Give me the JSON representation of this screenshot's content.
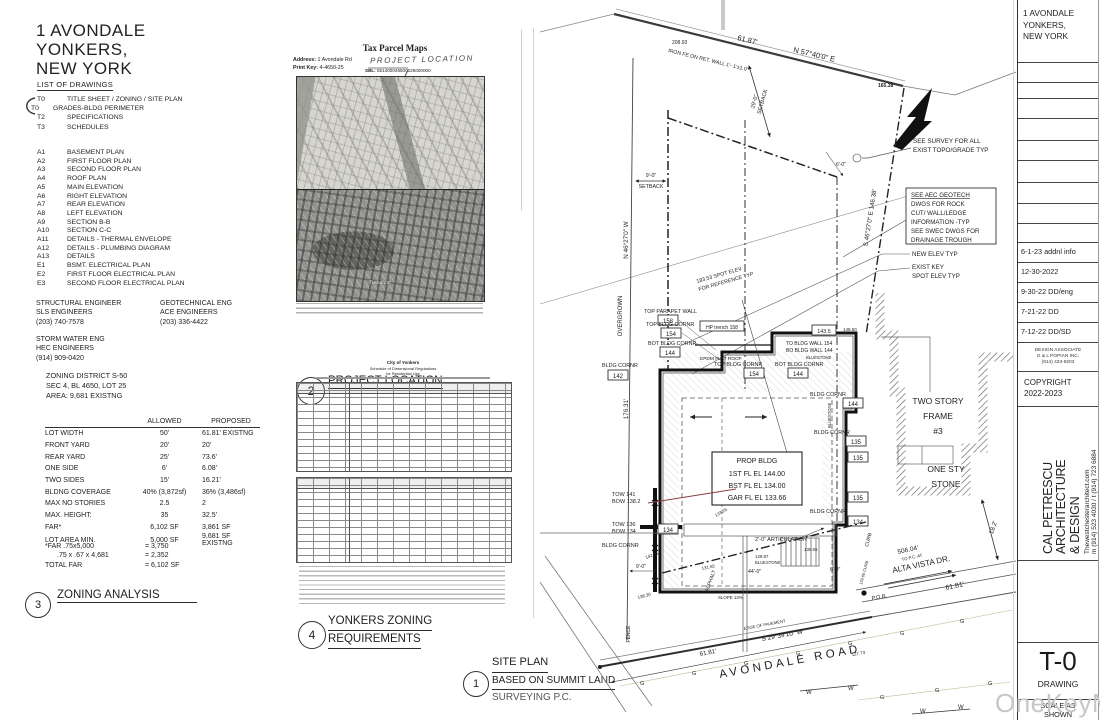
{
  "project": {
    "title_lines": [
      "1 AVONDALE",
      "YONKERS,",
      "NEW YORK"
    ]
  },
  "drawing_list": {
    "heading": "LIST OF DRAWINGS",
    "t_items": [
      {
        "code": "T0",
        "name": "TITLE SHEET / ZONING / SITE PLAN"
      },
      {
        "code": "T0",
        "name": "GRADES-BLDG PERIMETER"
      },
      {
        "code": "T2",
        "name": "SPECIFICATIONS"
      },
      {
        "code": "T3",
        "name": "SCHEDULES"
      }
    ],
    "a_items": [
      {
        "code": "A1",
        "name": "BASEMENT PLAN"
      },
      {
        "code": "A2",
        "name": "FIRST FLOOR PLAN"
      },
      {
        "code": "A3",
        "name": "SECOND FLOOR PLAN"
      },
      {
        "code": "A4",
        "name": "ROOF PLAN"
      },
      {
        "code": "A5",
        "name": "MAIN ELEVATION"
      },
      {
        "code": "A6",
        "name": "RIGHT ELEVATION"
      },
      {
        "code": "A7",
        "name": "REAR ELEVATION"
      },
      {
        "code": "A8",
        "name": "LEFT ELEVATION"
      },
      {
        "code": "A9",
        "name": "SECTION B-B"
      },
      {
        "code": "A10",
        "name": "SECTION C-C"
      },
      {
        "code": "A11",
        "name": "DETAILS - THERMAL ENVELOPE"
      },
      {
        "code": "A12",
        "name": "DETAILS - PLUMBING DIAGRAM"
      },
      {
        "code": "A13",
        "name": "DETAILS"
      },
      {
        "code": "E1",
        "name": "BSMT. ELECTRICAL PLAN"
      },
      {
        "code": "E2",
        "name": "FIRST FLOOR ELECTRICAL PLAN"
      },
      {
        "code": "E3",
        "name": "SECOND FLOOR ELECTRICAL PLAN"
      }
    ]
  },
  "engineers": [
    {
      "title": "STRUCTURAL ENGINEER",
      "firm": "SLS ENGINEERS",
      "phone": "(203) 740-7578"
    },
    {
      "title": "GEOTECHNICAL ENG",
      "firm": "ACE ENGINEERS",
      "phone": "(203) 336-4422"
    },
    {
      "title": "STORM WATER ENG",
      "firm": "HEC ENGINEERS",
      "phone": "(914) 909-0420"
    }
  ],
  "zoning": {
    "district_lines": [
      "ZONING DISTRICT S-50",
      "SEC 4, BL 4650, LOT 25",
      "AREA: 9,681 EXISTNG"
    ],
    "table": {
      "headers": [
        "ALLOWED",
        "PROPOSED"
      ],
      "rows": [
        [
          "LOT WIDTH",
          "50'",
          "61.81'  EXISTNG"
        ],
        [
          "FRONT YARD",
          "20'",
          "20'"
        ],
        [
          "REAR YARD",
          "25'",
          "73.6'"
        ],
        [
          "ONE SIDE",
          "6'",
          "6.08'"
        ],
        [
          "TWO SIDES",
          "15'",
          "16.21'"
        ],
        [
          "BLDNG COVERAGE",
          "40% (3,872sf)",
          "36% (3,486sf)"
        ],
        [
          "MAX NO STORIES",
          "2.5",
          "2"
        ],
        [
          "MAX. HEIGHT:",
          "35",
          "32.5'"
        ],
        [
          "FAR*",
          "6,102  SF",
          "3,861 SF"
        ],
        [
          "LOT AREA MIN.",
          "5,000 SF",
          "9,681 SF  EXISTNG"
        ]
      ]
    },
    "far": [
      [
        "*FAR .75x5,000",
        "= 3,750"
      ],
      [
        ".75 x .67 x 4,681",
        "= 2,352"
      ],
      [
        "TOTAL FAR",
        "= 6,102 SF"
      ]
    ]
  },
  "callouts": {
    "c1": {
      "num": "1",
      "l1": "SITE PLAN",
      "l2": "BASED ON SUMMIT LAND",
      "l3": "SURVEYING P.C."
    },
    "c2": {
      "num": "2",
      "label": "PROJECT LOCATION"
    },
    "c3": {
      "num": "3",
      "label": "ZONING ANALYSIS"
    },
    "c4": {
      "num": "4",
      "l1": "YONKERS ZONING",
      "l2": "REQUIREMENTS"
    }
  },
  "parcel": {
    "title": "Tax Parcel Maps",
    "address_label": "Address:",
    "address": "1 Avondale Rd",
    "printkey_label": "Print Key:",
    "printkey": "4-4650-25",
    "sbl_label": "SBL:",
    "sbl": "551400046500025000000",
    "handwriting": "PROJECT LOCATION",
    "map_town": "Tuckahoe"
  },
  "yonkers": {
    "h1": "City of Yonkers",
    "h2": "Schedule of Dimensional Regulations",
    "h3": "for Residential Use"
  },
  "site": {
    "labels": {
      "dist_top": "61.87'",
      "brg_top": "N 57°40'0\" E",
      "iron": "IRON FE ON RET. WALL  1'- 1'±1.0'",
      "s20893": "208.93",
      "s16538": "165.38",
      "sb29_1": "29'-0\"",
      "sb29_2": "SETBACK",
      "survey1": "SEE SURVEY FOR ALL",
      "survey2": "EXIST TOPO/GRADE TYP",
      "aec1": "SEE AEC GEOTECH",
      "aec2": "DWGS FOR ROCK",
      "aec3": "CUT/ WALL/LEDGE",
      "aec4": "INFORMATION -TYP",
      "aec5": "SEE SWEC DWGS FOR",
      "aec6": "DRAINAGE TROUGH",
      "newelev": "NEW ELEV TYP",
      "ek1": "EXIST KEY",
      "ek2": "SPOT ELEV TYP",
      "brg_right": "S 46°27'0\" E   146.38'",
      "brg_left": "N 46°27'0\" W",
      "overgrown": "OVERGROWN",
      "len_left": "176.31'",
      "sb9_1": "9'-0\"",
      "sb9_2": "SETBACK",
      "ref1": "183.53 SPOT ELEV",
      "ref2": "FOR REFERENCE TYP",
      "tpw": "TOP PARAPET WALL",
      "v158": "158",
      "tbc": "TOP BLDG CORNR",
      "v154": "154",
      "bbc": "BOT BLDG CORNR",
      "v144": "144",
      "hp": "HP trench 158",
      "epdm": "EPDM FLAT ROOF",
      "towall": "TO BLDG WALL 154",
      "bowall": "BO BLDG WALL 144",
      "bluestone": "BLUESTONE",
      "s1435": "143.5",
      "s14850": "148.50",
      "bc": "BLDG CORNR",
      "v142": "142",
      "v135": "135",
      "v134": "134",
      "prop1": "PROP BLDG",
      "prop2": "1ST FL EL 144.00",
      "prop3": "BST FL EL 134.00",
      "prop4": "GAR FL EL 133.66",
      "artic": "2'-0\" ARTICULATION",
      "tow141": "TOW 141",
      "bow1382": "BOW 138.2",
      "tow136": "TOW 136",
      "bow134": "BOW 134",
      "d9": "9'-0\"",
      "s13830": "138.30",
      "fence": "FENCE",
      "asphalt": "ASPHALT",
      "slope": "SLOPE 13%",
      "d44": "44'-0\"",
      "d6": "6'-0\"",
      "s13055": "130.55",
      "s12987": "129.87",
      "s13325": "133.25",
      "s14295": "142.95",
      "s13165": "131.65",
      "two1": "TWO STORY",
      "two2": "FRAME",
      "two3": "#3",
      "one1": "ONE STY",
      "one2": "STONE",
      "d182": "18.2'",
      "alta1": "506.04'",
      "alta2": "TO P.C. AT",
      "alta3": "ALTA VISTA DR.",
      "d6181": "61.81'",
      "pob": "P.O.B.",
      "curb": "CURB",
      "curb2": "129.66 CURB",
      "eop": "EDGE OF PAVEMENT",
      "brg_bot": "S 29°39'10\" W",
      "road": "AVONDALE ROAD",
      "s12773": "127.73",
      "g": "G",
      "w": "W"
    }
  },
  "titleblock": {
    "project_lines": [
      "1 AVONDALE",
      "YONKERS,",
      "NEW YORK"
    ],
    "revisions": [
      "6-1-23 addnl info",
      "12-30-2022",
      "9-30-22 DD/eng",
      "7-21-22 DD",
      "7-12-22 DD/SD"
    ],
    "associate_lines": [
      "DESIGN ASSOCIATE",
      "G & L POPIAN INC.",
      "(914) 433-9203"
    ],
    "copyright_lines": [
      "COPYRIGHT",
      "2022-2023"
    ],
    "architect": {
      "name_lines": [
        "CAL PETRESCU",
        "ARCHITECTURE",
        "& DESIGN"
      ],
      "website": "Thewestchesterarchitect.com",
      "phone": "m (914) 523 4030 / t (914) 723 6884"
    },
    "sheet": {
      "number": "T-0",
      "label": "DRAWING",
      "scale_lines": [
        "SCALE AS",
        "SHOWN"
      ]
    }
  },
  "watermark": "OneKeyMLS"
}
